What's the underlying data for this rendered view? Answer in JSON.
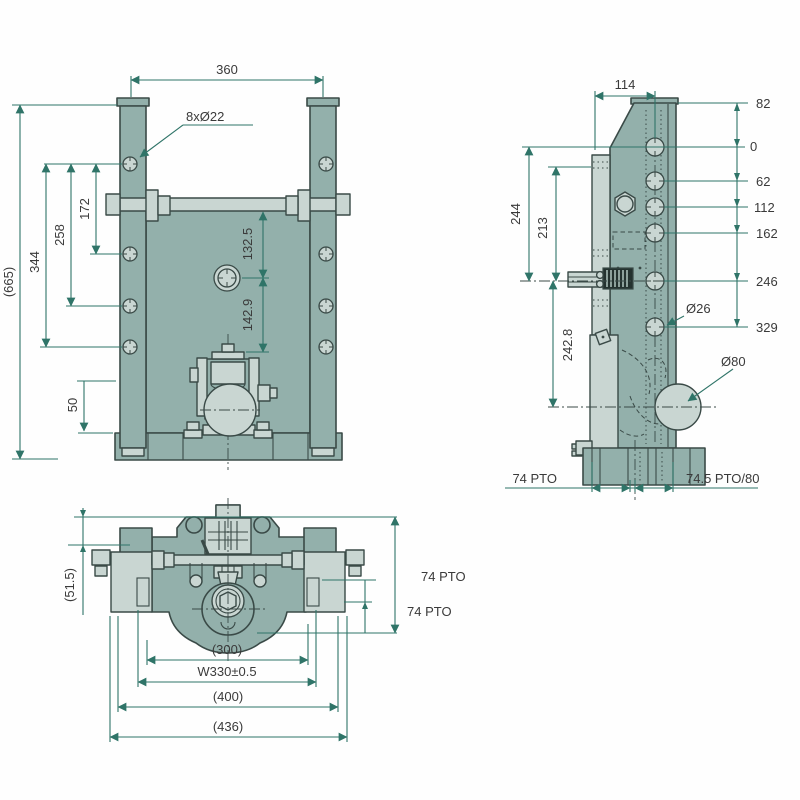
{
  "drawing": {
    "colors": {
      "body_fill": "#93b0ab",
      "part_light_fill": "#c9d6d2",
      "outline": "#3a4a47",
      "dimension_lines": "#2f7468",
      "text": "#3a3a3a",
      "background": "#fefefe"
    },
    "front_view": {
      "labels": {
        "width_360": "360",
        "holes_note": "8xØ22",
        "h172": "172",
        "h258": "258",
        "h344": "344",
        "total_665": "(665)",
        "d132_5": "132.5",
        "d142_9": "142.9",
        "d50": "50"
      }
    },
    "side_view": {
      "labels": {
        "w114": "114",
        "r82": "82",
        "r0": "0",
        "r62": "62",
        "r112": "112",
        "r162": "162",
        "r246": "246",
        "r329": "329",
        "hole_d26": "Ø26",
        "ball_d80": "Ø80",
        "l244": "244",
        "l213": "213",
        "l242_8": "242.8",
        "pto_left": "74 PTO",
        "pto_right": "74.5 PTO/80"
      }
    },
    "bottom_view": {
      "labels": {
        "h51_5": "(51.5)",
        "pto_a": "74 PTO",
        "pto_b": "74 PTO",
        "w300": "(300)",
        "w330": "W330±0.5",
        "w400": "(400)",
        "w436": "(436)"
      }
    }
  }
}
